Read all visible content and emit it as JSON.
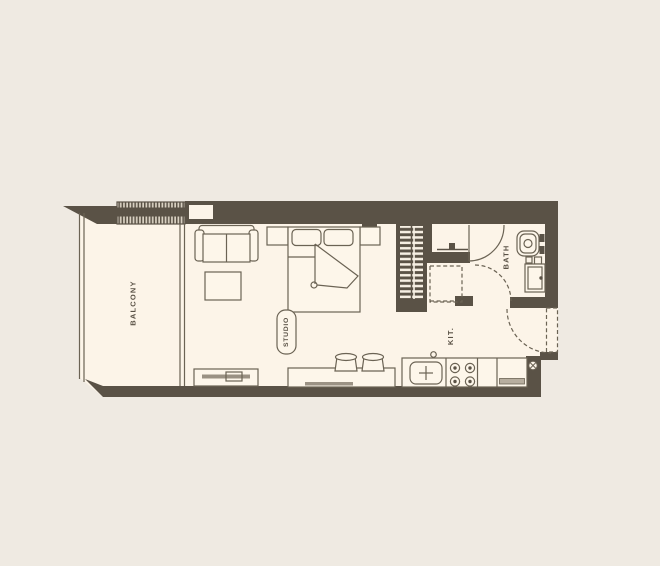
{
  "floorplan": {
    "labels": {
      "balcony": "BALCONY",
      "studio": "STUDIO",
      "kitchen": "KIT.",
      "bath": "BATH"
    },
    "colors": {
      "background": "#efeae2",
      "floor": "#fcf4e8",
      "wall": "#5a5246",
      "outline": "#6b6354",
      "label_text": "#5a5246"
    },
    "fixtures": [
      "balcony-louver-screen",
      "sofa",
      "coffee-table",
      "tv-console",
      "double-bed",
      "nightstand-left",
      "nightstand-right",
      "studio-label-pill",
      "wardrobe",
      "washer-space",
      "water-tap",
      "bar-counter",
      "bar-stool",
      "kitchen-sink",
      "stove-burners",
      "refrigerator",
      "toilet",
      "washbasin",
      "bath-door",
      "hall-door",
      "entry-door",
      "drain-symbol"
    ]
  }
}
